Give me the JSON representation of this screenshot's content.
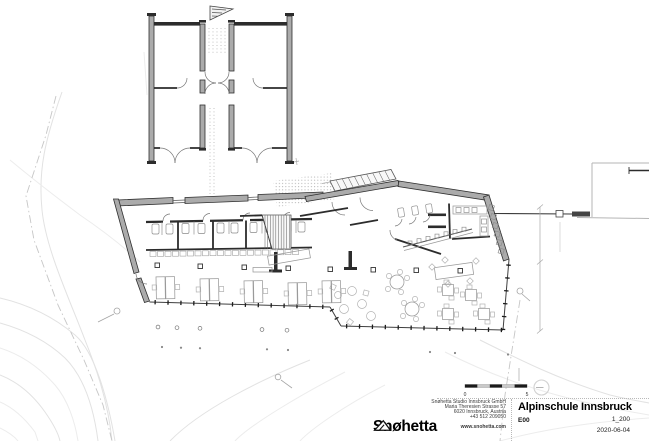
{
  "drawing": {
    "scale_bar": {
      "start_label": "0",
      "end_label": "5"
    }
  },
  "title_block": {
    "logo_text": "Snøhetta",
    "firm": {
      "line1": "Snøhetta Studio Innsbruck GmbH",
      "line2": "Maria Theresien Strasse 57",
      "line3": "6020 Innsbruck, Austria",
      "line4": "+43 512 209050",
      "website": "www.snohetta.com"
    },
    "project_title": "Alpinschule Innsbruck",
    "sheet_code": "E00",
    "scale": "1_200",
    "date": "2020-06-04"
  },
  "colors": {
    "wall_poche": "#ababab",
    "wall_dark": "#2c2c2c",
    "contour": "#e2e2e2"
  }
}
